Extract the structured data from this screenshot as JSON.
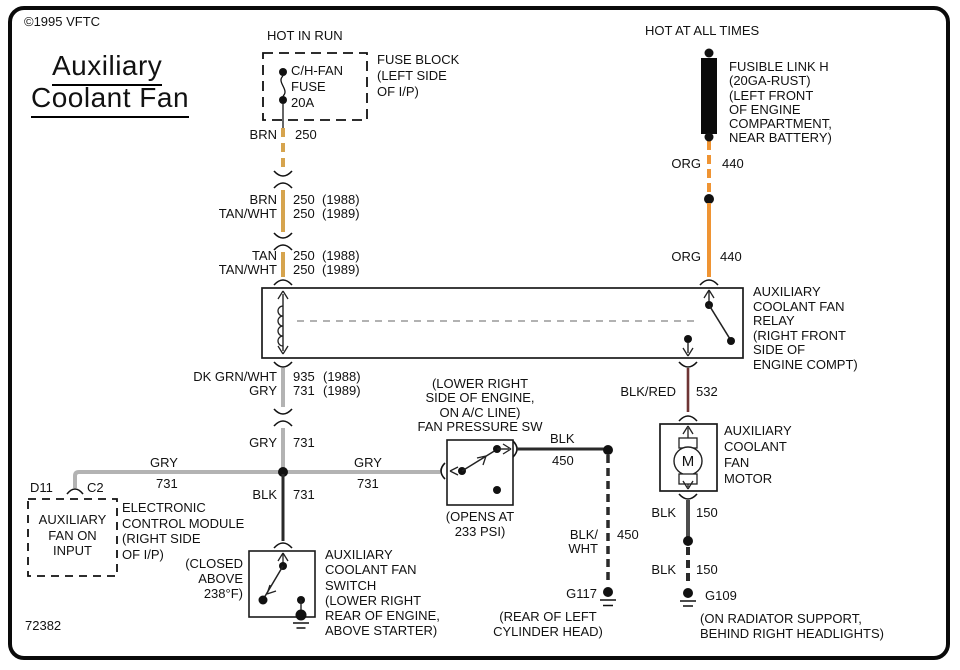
{
  "meta": {
    "copyright": "©1995 VFTC",
    "title_line1": "Auxiliary",
    "title_line2": "Coolant Fan",
    "diagram_number": "72382"
  },
  "power": {
    "hot_in_run": "HOT IN RUN",
    "hot_at_all_times": "HOT AT ALL TIMES"
  },
  "fuse_block": {
    "fuse_lines": [
      "C/H-FAN",
      "FUSE",
      "20A"
    ],
    "label_lines": [
      "FUSE BLOCK",
      "(LEFT SIDE",
      "OF I/P)"
    ]
  },
  "fusible_link": {
    "label_lines": [
      "FUSIBLE LINK H",
      "(20GA-RUST)",
      "(LEFT FRONT",
      "OF ENGINE",
      "COMPARTMENT,",
      "NEAR BATTERY)"
    ]
  },
  "relay": {
    "label_lines": [
      "AUXILIARY",
      "COOLANT FAN",
      "RELAY",
      "(RIGHT FRONT",
      "SIDE OF",
      "ENGINE COMPT)"
    ]
  },
  "motor": {
    "symbol": "M",
    "label_lines": [
      "AUXILIARY",
      "COOLANT",
      "FAN",
      "MOTOR"
    ]
  },
  "pressure_switch": {
    "label_lines": [
      "(LOWER RIGHT",
      "SIDE OF ENGINE,",
      "ON A/C LINE)",
      "FAN PRESSURE SW"
    ],
    "note_lines": [
      "(OPENS AT",
      "233 PSI)"
    ]
  },
  "fan_switch": {
    "note_lines": [
      "(CLOSED",
      "ABOVE",
      "238°F)"
    ],
    "label_lines": [
      "AUXILIARY",
      "COOLANT FAN",
      "SWITCH",
      "(LOWER RIGHT",
      "REAR OF ENGINE,",
      "ABOVE STARTER)"
    ]
  },
  "ecm": {
    "pin": "D11",
    "connector": "C2",
    "box_lines": [
      "AUXILIARY",
      "FAN ON",
      "INPUT"
    ],
    "label_lines": [
      "ELECTRONIC",
      "CONTROL MODULE",
      "(RIGHT SIDE",
      "OF I/P)"
    ]
  },
  "grounds": {
    "g117": {
      "name": "G117",
      "label_lines": [
        "(REAR OF LEFT",
        "CYLINDER HEAD)"
      ]
    },
    "g109": {
      "name": "G109",
      "label_lines": [
        "(ON RADIATOR SUPPORT,",
        "BEHIND RIGHT HEADLIGHTS)"
      ]
    }
  },
  "wires": {
    "brn_250": {
      "color": "BRN",
      "circuit": "250"
    },
    "brn_tanwht": {
      "rows": [
        {
          "color": "BRN",
          "circuit": "250",
          "year": "(1988)"
        },
        {
          "color": "TAN/WHT",
          "circuit": "250",
          "year": "(1989)"
        }
      ]
    },
    "tan_tanwht": {
      "rows": [
        {
          "color": "TAN",
          "circuit": "250",
          "year": "(1988)"
        },
        {
          "color": "TAN/WHT",
          "circuit": "250",
          "year": "(1989)"
        }
      ]
    },
    "org_upper": {
      "color": "ORG",
      "circuit": "440"
    },
    "org_lower": {
      "color": "ORG",
      "circuit": "440"
    },
    "dkgrn_gry": {
      "rows": [
        {
          "color": "DK GRN/WHT",
          "circuit": "935",
          "year": "(1988)"
        },
        {
          "color": "GRY",
          "circuit": "731",
          "year": "(1989)"
        }
      ]
    },
    "gry_vert": {
      "color": "GRY",
      "circuit": "731"
    },
    "gry_left": {
      "color": "GRY",
      "circuit": "731"
    },
    "gry_right": {
      "color": "GRY",
      "circuit": "731"
    },
    "blk_731": {
      "color": "BLK",
      "circuit": "731"
    },
    "blk_450": {
      "color": "BLK",
      "circuit": "450"
    },
    "blkwht_450": {
      "color_line1": "BLK/",
      "color_line2": "WHT",
      "circuit": "450"
    },
    "blkred_532": {
      "color": "BLK/RED",
      "circuit": "532"
    },
    "blk_150_upper": {
      "color": "BLK",
      "circuit": "150"
    },
    "blk_150_lower": {
      "color": "BLK",
      "circuit": "150"
    }
  },
  "colors": {
    "tan": "#D6A44E",
    "orange": "#EF9433",
    "gray": "#B3B3B3",
    "black_wire": "#2A2A2A",
    "dark_gray_wire": "#4D4D4D",
    "maroon": "#6E3434"
  }
}
